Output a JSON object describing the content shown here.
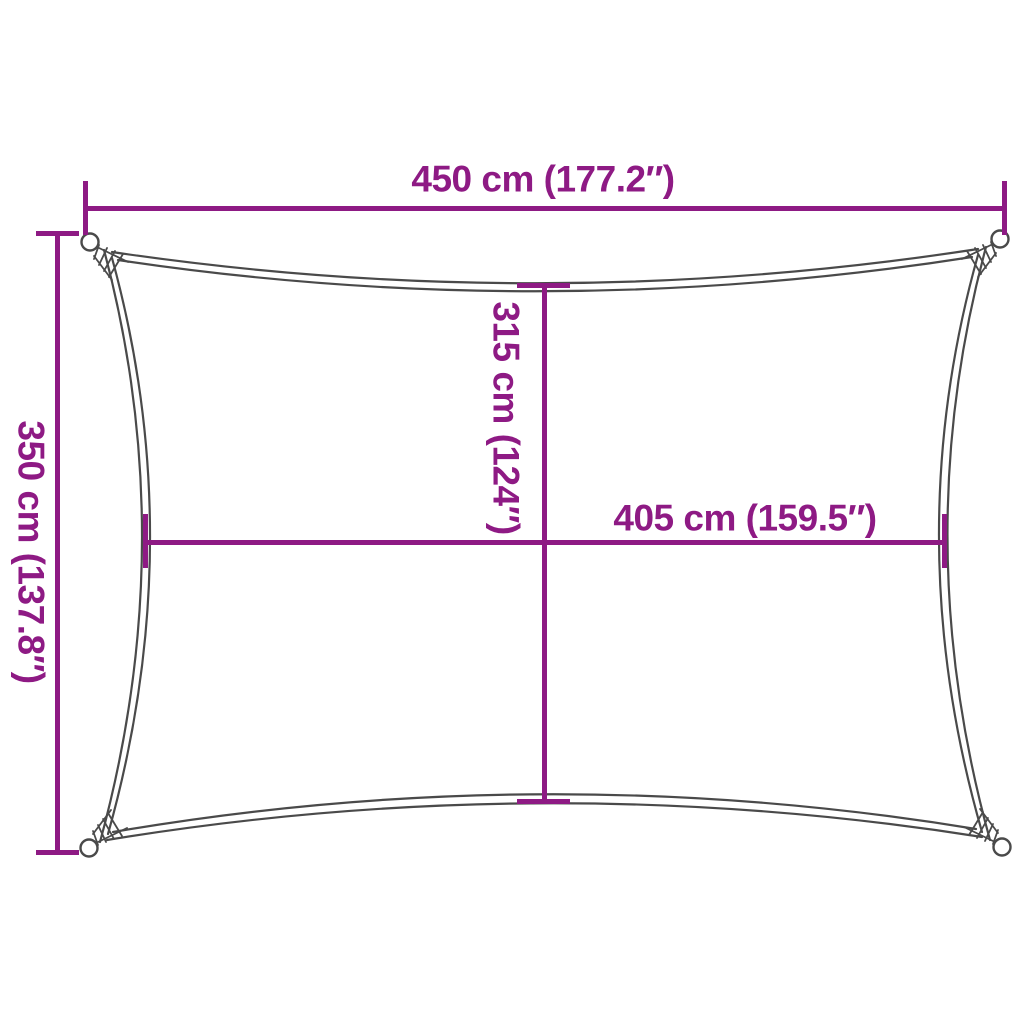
{
  "figure": {
    "type": "product-dimension-diagram",
    "subject": "rectangular-shade-sail"
  },
  "colors": {
    "accent": "#8E1A84",
    "outline": "#4a4a4a",
    "background": "#ffffff"
  },
  "dimensions": {
    "top_width": {
      "label": "450 cm (177.2″)"
    },
    "left_height": {
      "label": "350 cm (137.8″)"
    },
    "center_height": {
      "label": "315 cm (124″)"
    },
    "center_width": {
      "label": "405 cm (159.5″)"
    }
  }
}
